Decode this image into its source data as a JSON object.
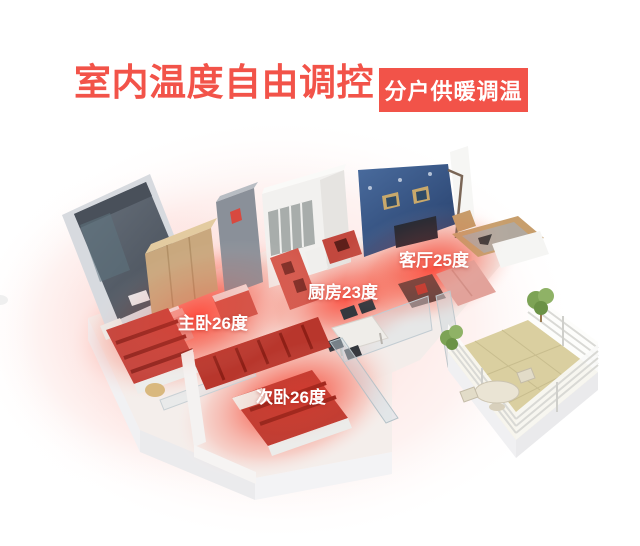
{
  "header": {
    "title": "室内温度自由调控",
    "badge": "分户供暖调温"
  },
  "colors": {
    "accent_red": "#F25349",
    "heat_glow_red": "#FF4638",
    "feature_wall_blue": "#2E4A76",
    "balcony_floor_tan": "#DACFA0",
    "label_text": "#FFFFFF"
  },
  "rooms": [
    {
      "id": "master-bedroom",
      "label": "主卧26度",
      "temperature_c": 26
    },
    {
      "id": "kitchen",
      "label": "厨房23度",
      "temperature_c": 23
    },
    {
      "id": "living-room",
      "label": "客厅25度",
      "temperature_c": 25
    },
    {
      "id": "second-bedroom",
      "label": "次卧26度",
      "temperature_c": 26
    }
  ]
}
